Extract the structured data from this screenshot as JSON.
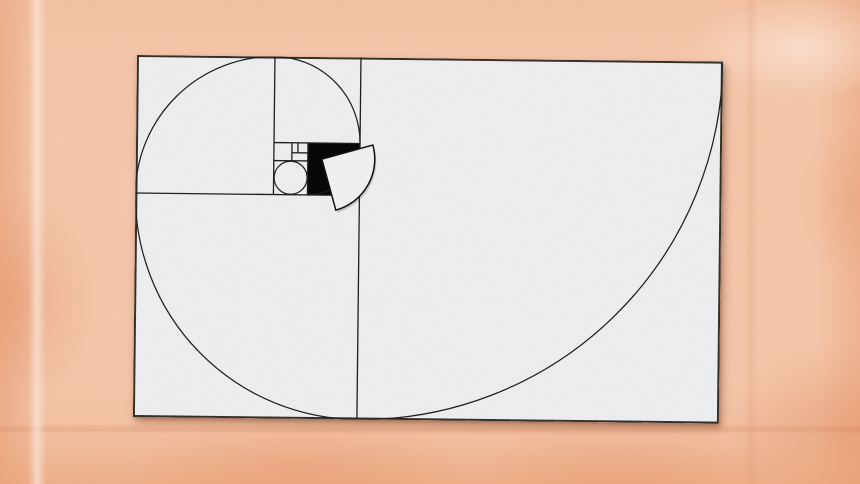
{
  "scene": {
    "description": "Fibonacci golden-rectangle spiral diagram on a light paper card, slightly rotated, over peach textured paper background",
    "background": {
      "base_color": "#f5c6a9",
      "highlight_color": "#fde9dd",
      "shade_color": "#e99c6e",
      "crease_color": "#c87350"
    },
    "card": {
      "fill": "#edeef0",
      "border_color": "#33302c",
      "line_color": "#1f1f1f",
      "black_square_color": "#070707",
      "x": 137,
      "y": 55,
      "width": 586,
      "height": 362,
      "rotation_deg": 0.65
    }
  },
  "diagram": {
    "coordinate_note": "card-local px, origin top-left of card",
    "fibonacci_square_sides": [
      362,
      224,
      138,
      86,
      52,
      34,
      18
    ],
    "dividers": [
      {
        "name": "v-main",
        "x1": 224,
        "y1": 0,
        "x2": 224,
        "y2": 362
      },
      {
        "name": "h-1",
        "x1": 0,
        "y1": 138,
        "x2": 224,
        "y2": 138
      },
      {
        "name": "v-2",
        "x1": 138,
        "y1": 0,
        "x2": 138,
        "y2": 138
      },
      {
        "name": "h-2",
        "x1": 138,
        "y1": 86,
        "x2": 224,
        "y2": 86
      },
      {
        "name": "v-3",
        "x1": 172,
        "y1": 86,
        "x2": 172,
        "y2": 138
      },
      {
        "name": "h-3",
        "x1": 138,
        "y1": 104,
        "x2": 172,
        "y2": 104
      },
      {
        "name": "v-4",
        "x1": 156,
        "y1": 86,
        "x2": 156,
        "y2": 104
      },
      {
        "name": "h-4",
        "x1": 156,
        "y1": 96,
        "x2": 172,
        "y2": 96
      },
      {
        "name": "v-5",
        "x1": 162,
        "y1": 86,
        "x2": 162,
        "y2": 96
      }
    ],
    "black_square": {
      "x": 172,
      "y": 86,
      "size": 52
    },
    "spiral": {
      "start": [
        586,
        0
      ],
      "arcs": [
        {
          "r": 362,
          "to": [
            224,
            362
          ]
        },
        {
          "r": 224,
          "to": [
            0,
            138
          ]
        },
        {
          "r": 138,
          "to": [
            138,
            0
          ]
        },
        {
          "r": 86,
          "to": [
            224,
            86
          ]
        },
        {
          "r": 52,
          "to": [
            172,
            138
          ]
        }
      ]
    },
    "inner_circle": {
      "cx": 155,
      "cy": 121,
      "r": 16.5
    },
    "displaced_sector": {
      "cx": 186,
      "cy": 102,
      "r": 53,
      "start_angle_deg": -16,
      "sweep_deg": 90,
      "fill": "#f0f1f2",
      "stroke": "#141414",
      "shadow_offset": [
        1.5,
        2.5
      ]
    }
  }
}
